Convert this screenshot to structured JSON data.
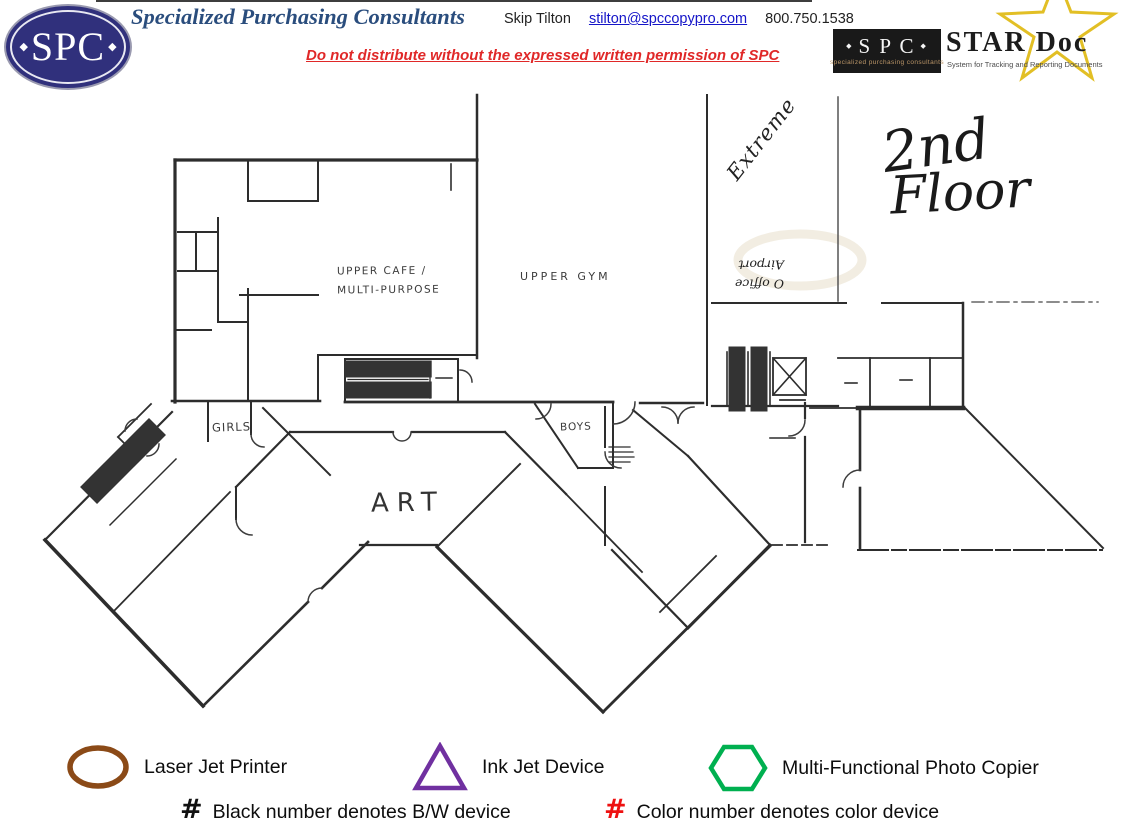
{
  "header": {
    "logo_text": "SPC",
    "company_name": "Specialized Purchasing Consultants",
    "contact_name": "Skip Tilton",
    "contact_email": "stilton@spccopypro.com",
    "contact_phone": "800.750.1538",
    "distribution_warning": "Do not distribute without the expressed written permission of SPC",
    "stardoc": {
      "box_text": "S P C",
      "box_subtext": "specialized purchasing consultants",
      "title": "STAR Doc",
      "subtitle": "System for Tracking and Reporting Documents"
    }
  },
  "floor_plan": {
    "floor_title_line1": "2nd",
    "floor_title_line2": "Floor",
    "labels": {
      "upper_cafe_line1": "UPPER CAFE /",
      "upper_cafe_line2": "MULTI-PURPOSE",
      "upper_gym": "UPPER GYM",
      "girls": "GIRLS",
      "boys": "BOYS",
      "art": "ART",
      "extreme": "Extreme",
      "airport_note_line1": "O office",
      "airport_note_line2": "Airport"
    }
  },
  "legend": {
    "devices": [
      {
        "symbol": "ellipse",
        "color": "#8B4A17",
        "label": "Laser Jet Printer"
      },
      {
        "symbol": "triangle",
        "color": "#7030A0",
        "label": "Ink Jet Device"
      },
      {
        "symbol": "hexagon",
        "color": "#00B050",
        "label": "Multi-Functional Photo Copier"
      }
    ],
    "notes": [
      {
        "symbol": "#",
        "color": "#111111",
        "label": "Black number denotes B/W device"
      },
      {
        "symbol": "#",
        "color": "#EE1111",
        "label": "Color number denotes color device"
      }
    ]
  }
}
